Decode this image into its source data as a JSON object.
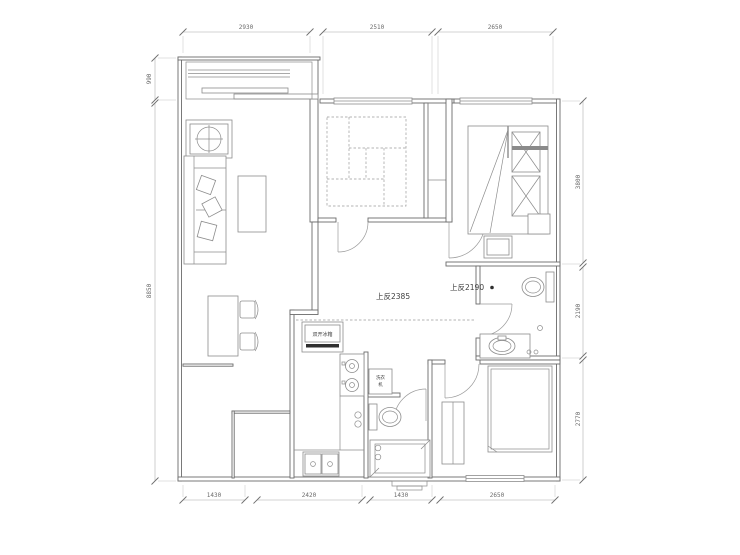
{
  "plan": {
    "annotations": {
      "beam_left": "上反2385",
      "beam_right": "上反2190",
      "fridge": "双开冰箱",
      "washer_line1": "洗衣",
      "washer_line2": "机"
    },
    "dimensions": {
      "top": [
        "2930",
        "2510",
        "2650"
      ],
      "bottom": [
        "1430",
        "2420",
        "1430",
        "2650"
      ],
      "left": [
        "990",
        "8850"
      ],
      "right": [
        "3800",
        "2190",
        "2770"
      ]
    },
    "colors": {
      "background": "#ffffff",
      "wall_line": "#6b6b6b",
      "furniture_line": "#8c8c8c",
      "dim_line": "#9a9a9a",
      "text": "#4e4e4e",
      "accent_dark": "#2f2f2f"
    }
  }
}
